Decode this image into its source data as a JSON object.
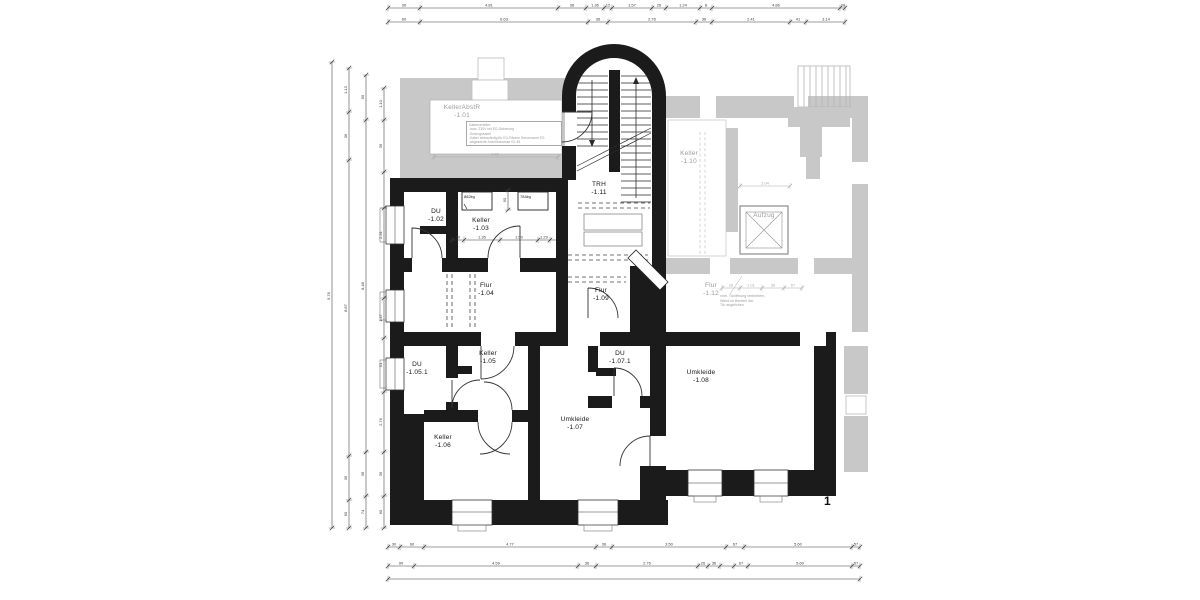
{
  "sheet_number": "1",
  "colors": {
    "wall": "#1b1b1b",
    "existing_gray": "#c8c8c8",
    "dim": "#3a3a3a",
    "gray_text": "#9b9b9b"
  },
  "rooms": [
    {
      "name": "DU",
      "num": "-1.02",
      "x": 436,
      "y": 208
    },
    {
      "name": "Keller",
      "num": "-1.03",
      "x": 481,
      "y": 217
    },
    {
      "name": "Flur",
      "num": "-1.04",
      "x": 486,
      "y": 282
    },
    {
      "name": "TRH",
      "num": "-1.11",
      "x": 599,
      "y": 181
    },
    {
      "name": "Flur",
      "num": "-1.09",
      "x": 601,
      "y": 287
    },
    {
      "name": "DU",
      "num": "-1.05.1",
      "x": 417,
      "y": 361
    },
    {
      "name": "Keller",
      "num": "-1.05",
      "x": 488,
      "y": 350
    },
    {
      "name": "DU",
      "num": "-1.07.1",
      "x": 620,
      "y": 350
    },
    {
      "name": "Keller",
      "num": "-1.06",
      "x": 443,
      "y": 434
    },
    {
      "name": "Umkleide",
      "num": "-1.07",
      "x": 575,
      "y": 416
    },
    {
      "name": "Umkleide",
      "num": "-1.08",
      "x": 701,
      "y": 369
    },
    {
      "name": "KellerAbstR",
      "num": "-1.01",
      "x": 462,
      "y": 104,
      "gray": true
    },
    {
      "name": "Keller",
      "num": "-1.10",
      "x": 689,
      "y": 150,
      "gray": true
    },
    {
      "name": "Flur",
      "num": "-1.12",
      "x": 711,
      "y": 282,
      "gray": true
    },
    {
      "name": "Aufzug",
      "num": "",
      "x": 764,
      "y": 212,
      "gray": true
    }
  ],
  "annotations": [
    {
      "text": "882kg",
      "x": 464,
      "y": 194,
      "cls": "kg"
    },
    {
      "text": "784kg",
      "x": 520,
      "y": 194,
      "cls": "kg"
    },
    {
      "text": "T30",
      "x": 569,
      "y": 168,
      "cls": "rot"
    }
  ],
  "notes_box": {
    "lines": [
      "Datenverteiler:",
      "-max. 230V mit EG-Sicherung",
      "-Erdungskabel",
      "-Kabel einbaufertig für KU-Räume Serverraum EG",
      "-abgesetzte Anschlussdose RJ-45"
    ]
  },
  "wall_note": {
    "lines": [
      "vorh. Türöffnung verbreitern,",
      "Wand im Bereich der",
      "Tür angleichen"
    ]
  },
  "dims": [
    {
      "o": "h",
      "y": 8,
      "x1": 388,
      "x2": 845,
      "ticks": [
        388,
        420,
        558,
        586,
        604,
        612,
        652,
        666,
        700,
        712,
        840,
        845
      ],
      "labels": [
        {
          "at": 404,
          "t": "30"
        },
        {
          "at": 489,
          "t": "4.81"
        },
        {
          "at": 572,
          "t": "36"
        },
        {
          "at": 595,
          "t": "1.36"
        },
        {
          "at": 608,
          "t": "12"
        },
        {
          "at": 632,
          "t": "1.57"
        },
        {
          "at": 659,
          "t": "26"
        },
        {
          "at": 683,
          "t": "1.24"
        },
        {
          "at": 706,
          "t": "8"
        },
        {
          "at": 776,
          "t": "4.86"
        },
        {
          "at": 843,
          "t": "26"
        }
      ]
    },
    {
      "o": "h",
      "y": 22,
      "x1": 388,
      "x2": 845,
      "ticks": [
        388,
        420,
        588,
        608,
        696,
        712,
        790,
        806,
        845
      ],
      "labels": [
        {
          "at": 404,
          "t": "60"
        },
        {
          "at": 504,
          "t": "6.63"
        },
        {
          "at": 598,
          "t": "36"
        },
        {
          "at": 652,
          "t": "2.76"
        },
        {
          "at": 704,
          "t": "36"
        },
        {
          "at": 751,
          "t": "2.41"
        },
        {
          "at": 798,
          "t": "41"
        },
        {
          "at": 826,
          "t": "3.14"
        }
      ]
    },
    {
      "o": "h",
      "y": 547,
      "x1": 388,
      "x2": 860,
      "ticks": [
        388,
        400,
        424,
        596,
        612,
        726,
        744,
        852,
        860
      ],
      "labels": [
        {
          "at": 394,
          "t": "30"
        },
        {
          "at": 412,
          "t": "60"
        },
        {
          "at": 510,
          "t": "4.77"
        },
        {
          "at": 604,
          "t": "36"
        },
        {
          "at": 669,
          "t": "3.50"
        },
        {
          "at": 735,
          "t": "67"
        },
        {
          "at": 798,
          "t": "5.60"
        },
        {
          "at": 856,
          "t": "57"
        }
      ]
    },
    {
      "o": "h",
      "y": 566,
      "x1": 388,
      "x2": 860,
      "ticks": [
        388,
        414,
        578,
        596,
        698,
        708,
        720,
        734,
        748,
        852,
        860
      ],
      "labels": [
        {
          "at": 401,
          "t": "90"
        },
        {
          "at": 496,
          "t": "4.59"
        },
        {
          "at": 587,
          "t": "36"
        },
        {
          "at": 647,
          "t": "2.76"
        },
        {
          "at": 703,
          "t": "26"
        },
        {
          "at": 714,
          "t": "36"
        },
        {
          "at": 741,
          "t": "67"
        },
        {
          "at": 800,
          "t": "5.60"
        },
        {
          "at": 856,
          "t": "57"
        }
      ]
    },
    {
      "o": "h",
      "y": 579,
      "x1": 388,
      "x2": 860,
      "ticks": [
        388,
        860
      ],
      "labels": []
    },
    {
      "o": "v",
      "x": 332,
      "y1": 62,
      "y2": 528,
      "ticks": [
        62,
        528
      ],
      "labels": [
        {
          "at": 296,
          "t": "9.76"
        }
      ]
    },
    {
      "o": "v",
      "x": 349,
      "y1": 68,
      "y2": 528,
      "ticks": [
        68,
        112,
        160,
        456,
        500,
        528
      ],
      "labels": [
        {
          "at": 90,
          "t": "1.13"
        },
        {
          "at": 136,
          "t": "36"
        },
        {
          "at": 308,
          "t": "8.87"
        },
        {
          "at": 478,
          "t": "36"
        },
        {
          "at": 514,
          "t": "60"
        }
      ]
    },
    {
      "o": "v",
      "x": 366,
      "y1": 75,
      "y2": 528,
      "ticks": [
        75,
        120,
        452,
        496,
        528
      ],
      "labels": [
        {
          "at": 97,
          "t": "95"
        },
        {
          "at": 286,
          "t": "8.48"
        },
        {
          "at": 474,
          "t": "36"
        },
        {
          "at": 512,
          "t": "74"
        }
      ]
    },
    {
      "o": "v",
      "x": 384,
      "y1": 88,
      "y2": 528,
      "ticks": [
        88,
        120,
        172,
        208,
        298,
        338,
        392,
        452,
        496,
        528
      ],
      "labels": [
        {
          "at": 104,
          "t": "1.10"
        },
        {
          "at": 146,
          "t": "36"
        },
        {
          "at": 235,
          "t": "2.31"
        },
        {
          "at": 318,
          "t": "1.47"
        },
        {
          "at": 365,
          "t": "51"
        },
        {
          "at": 422,
          "t": "2.76"
        },
        {
          "at": 474,
          "t": "36"
        },
        {
          "at": 512,
          "t": "60"
        }
      ]
    },
    {
      "o": "h",
      "y": 240,
      "x1": 452,
      "x2": 556,
      "ticks": [
        452,
        464,
        500,
        538,
        550
      ],
      "labels": [
        {
          "at": 458,
          "t": "50"
        },
        {
          "at": 482,
          "t": "1.35"
        },
        {
          "at": 519,
          "t": "1.50"
        },
        {
          "at": 544,
          "t": "1.29"
        }
      ]
    },
    {
      "o": "v",
      "x": 508,
      "y1": 190,
      "y2": 210,
      "ticks": [
        190,
        210
      ],
      "labels": [
        {
          "at": 200,
          "t": "90"
        }
      ]
    },
    {
      "o": "h",
      "y": 157,
      "x1": 434,
      "x2": 558,
      "ticks": [
        434,
        558
      ],
      "labels": [
        {
          "at": 495,
          "t": "4.86"
        }
      ],
      "gray": true
    },
    {
      "o": "h",
      "y": 186,
      "x1": 740,
      "x2": 790,
      "ticks": [
        740,
        790
      ],
      "labels": [
        {
          "at": 765,
          "t": "2.04"
        }
      ],
      "gray": true
    },
    {
      "o": "h",
      "y": 288,
      "x1": 722,
      "x2": 802,
      "ticks": [
        722,
        740,
        762,
        784,
        802
      ],
      "labels": [
        {
          "at": 731,
          "t": "26"
        },
        {
          "at": 751,
          "t": "1.01"
        },
        {
          "at": 773,
          "t": "36"
        },
        {
          "at": 793,
          "t": "67"
        }
      ],
      "gray": true
    }
  ]
}
